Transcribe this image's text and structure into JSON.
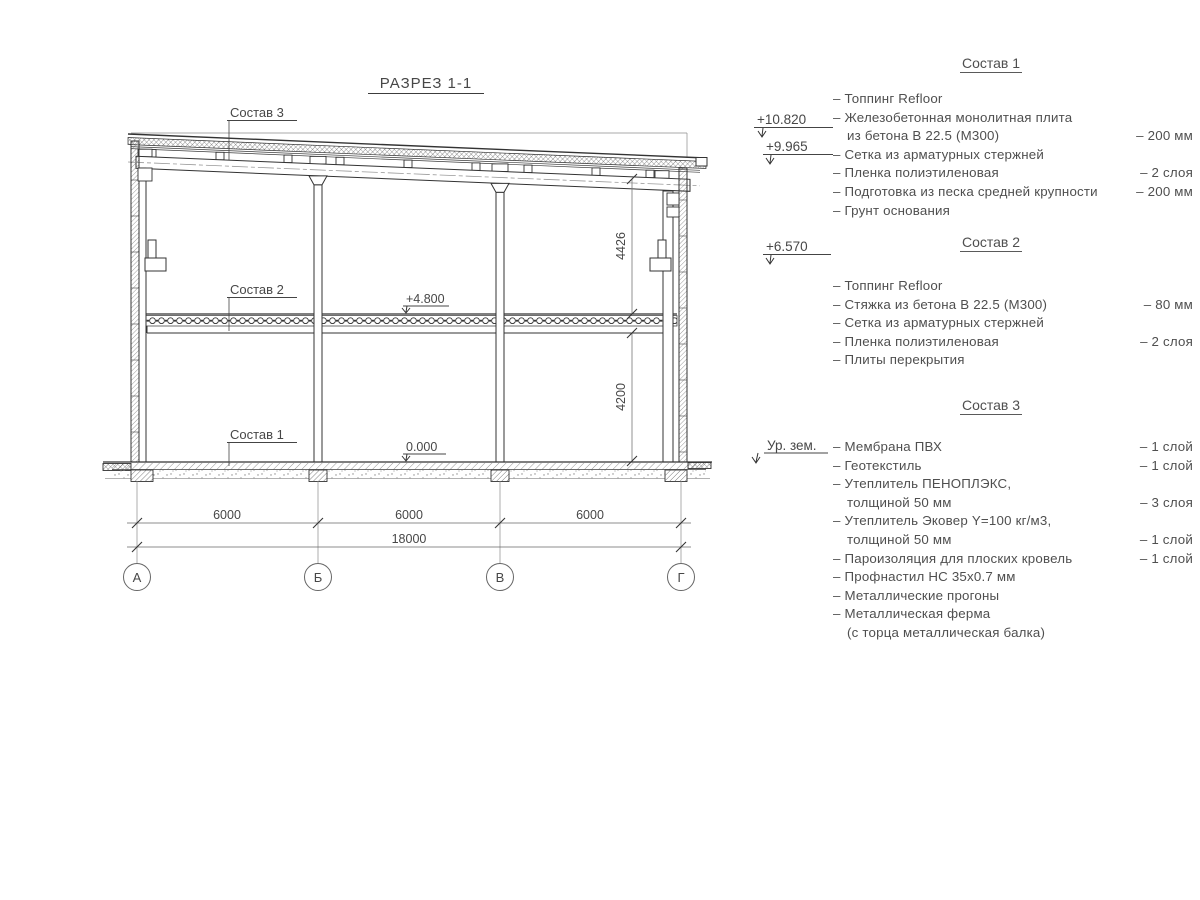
{
  "title": "РАЗРЕЗ 1-1",
  "section": {
    "callouts": {
      "c3": "Состав 3",
      "c2": "Состав 2",
      "c1": "Состав 1"
    },
    "elevations": {
      "roof_high": "+10.820",
      "roof_low": "+9.965",
      "mid": "+6.570",
      "floor2": "+4.800",
      "floor0": "0.000",
      "ground": "Ур. зем."
    },
    "dimensions": {
      "v_upper": "4426",
      "v_lower": "4200",
      "bay1": "6000",
      "bay2": "6000",
      "bay3": "6000",
      "total": "18000"
    },
    "axes": {
      "a": "А",
      "b": "Б",
      "v": "В",
      "g": "Г"
    }
  },
  "compositions": [
    {
      "heading": "Состав 1",
      "rows": [
        {
          "t": "– Топпинг Refloor",
          "v": ""
        },
        {
          "t": "– Железобетонная  монолитная плита",
          "v": ""
        },
        {
          "t": "из бетона В 22.5 (М300)",
          "v": "– 200 мм"
        },
        {
          "t": "– Сетка из арматурных стержней",
          "v": ""
        },
        {
          "t": "– Пленка полиэтиленовая",
          "v": "– 2 слоя"
        },
        {
          "t": "– Подготовка из песка средней крупности",
          "v": "– 200 мм"
        },
        {
          "t": "– Грунт основания",
          "v": ""
        }
      ]
    },
    {
      "heading": "Состав 2",
      "rows": [
        {
          "t": "– Топпинг Refloor",
          "v": ""
        },
        {
          "t": "– Стяжка из бетона В 22.5 (М300)",
          "v": "– 80 мм"
        },
        {
          "t": "– Сетка из арматурных стержней",
          "v": ""
        },
        {
          "t": "– Пленка полиэтиленовая",
          "v": "– 2 слоя"
        },
        {
          "t": "– Плиты перекрытия",
          "v": ""
        }
      ]
    },
    {
      "heading": "Состав 3",
      "rows": [
        {
          "t": "– Мембрана ПВХ",
          "v": "– 1 слой"
        },
        {
          "t": "– Геотекстиль",
          "v": "– 1 слой"
        },
        {
          "t": "– Утеплитель ПЕНОПЛЭКС,",
          "v": ""
        },
        {
          "t": "толщиной 50 мм",
          "v": "– 3 слоя"
        },
        {
          "t": "– Утеплитель Эковер Y=100 кг/м3,",
          "v": ""
        },
        {
          "t": "толщиной 50 мм",
          "v": "– 1 слой"
        },
        {
          "t": "– Пароизоляция для плоских кровель",
          "v": "– 1 слой"
        },
        {
          "t": "– Профнастил НС 35х0.7 мм",
          "v": ""
        },
        {
          "t": "– Металлические прогоны",
          "v": ""
        },
        {
          "t": "– Металлическая ферма",
          "v": ""
        },
        {
          "t": "(с торца металлическая балка)",
          "v": ""
        }
      ]
    }
  ]
}
